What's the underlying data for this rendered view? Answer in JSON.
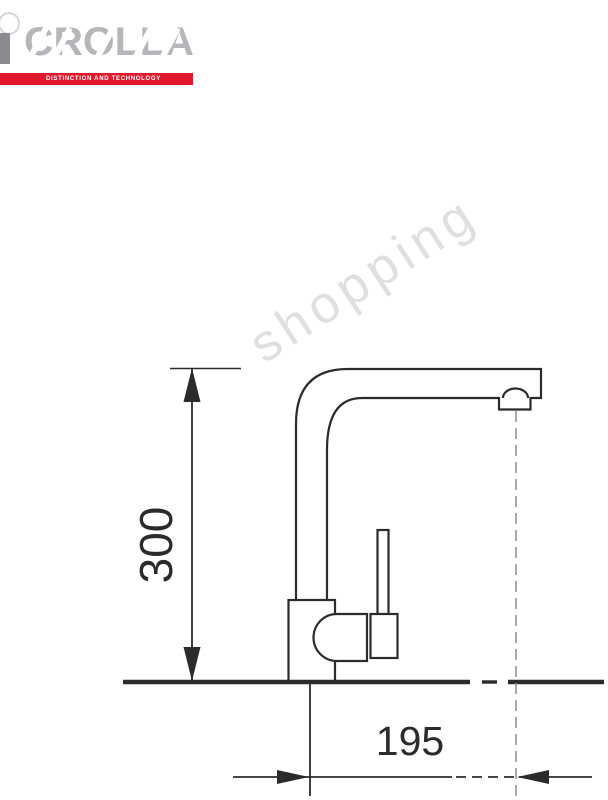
{
  "logo": {
    "brand": "CROLLA",
    "tagline": "DISTINCTION AND TECHNOLOGY",
    "brand_color": "#b6b6ba",
    "stem_color": "#8a8a8e",
    "banner_color": "#e0192c",
    "tagline_color": "#ffffff"
  },
  "watermark": {
    "text": "shopping"
  },
  "drawing": {
    "subject": "single-lever kitchen mixer tap, side elevation",
    "line_color": "#2b2b2b",
    "centerline_color": "#93939a",
    "dimensions": {
      "height_label": "300",
      "reach_label": "195"
    }
  }
}
